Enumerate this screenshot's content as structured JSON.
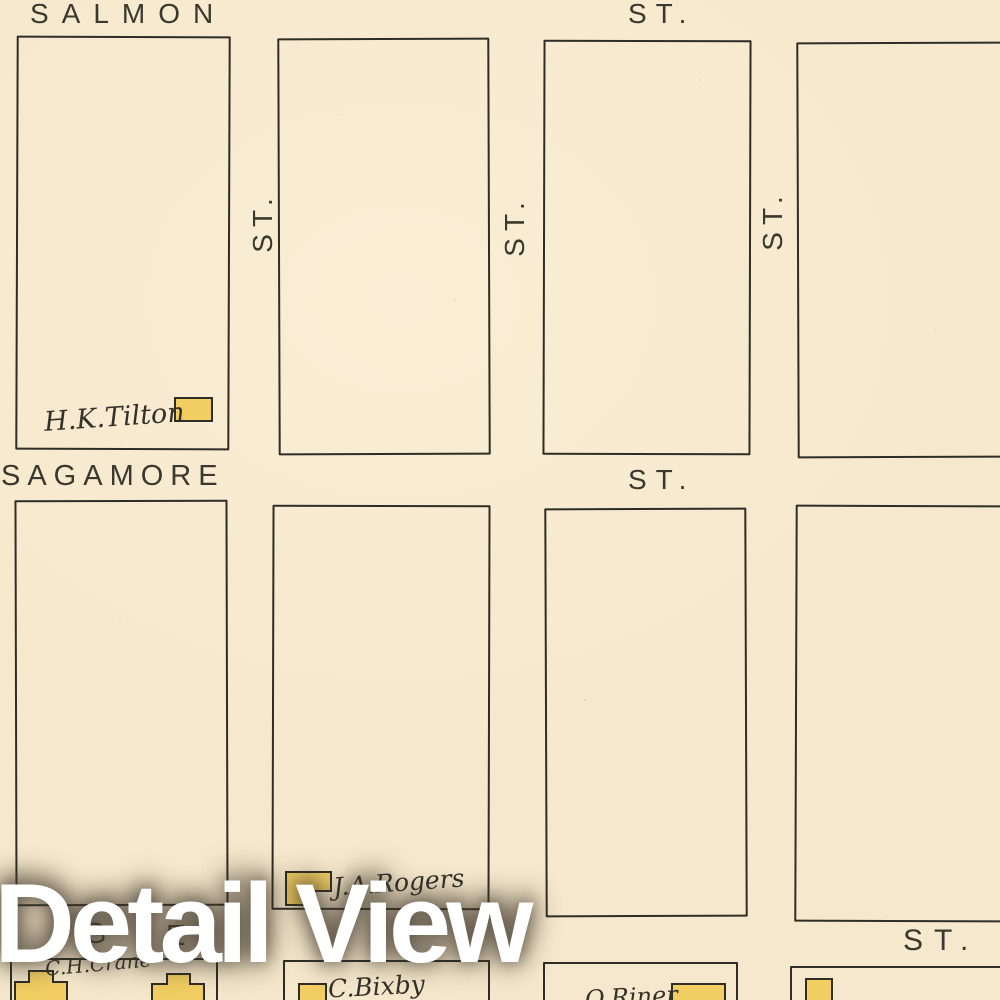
{
  "theme": {
    "paper": "#f6e8cc",
    "ink": "#2e2d26",
    "street_text": "#3a392f",
    "building_fill": "#f3cf63",
    "script_ink": "#33312a",
    "watermark_color": "#ffffff"
  },
  "streets": {
    "top": {
      "name": "SALMON",
      "suffix": "ST."
    },
    "middle": {
      "name": "SAGAMORE",
      "suffix": "ST."
    },
    "bottom": {
      "fragments": [
        "G",
        "E",
        "H"
      ],
      "suffix": "ST."
    },
    "vertical": [
      {
        "label": "ST."
      },
      {
        "label": "ST."
      },
      {
        "label": "ST."
      }
    ]
  },
  "properties": [
    {
      "owner": "H.K.Tilton"
    },
    {
      "owner": "J.A.Rogers"
    },
    {
      "owner": "C.H.Crane"
    },
    {
      "owner": "C.Bixby"
    },
    {
      "owner": "O.Riner"
    }
  ],
  "watermark": {
    "text": "Detail View"
  }
}
